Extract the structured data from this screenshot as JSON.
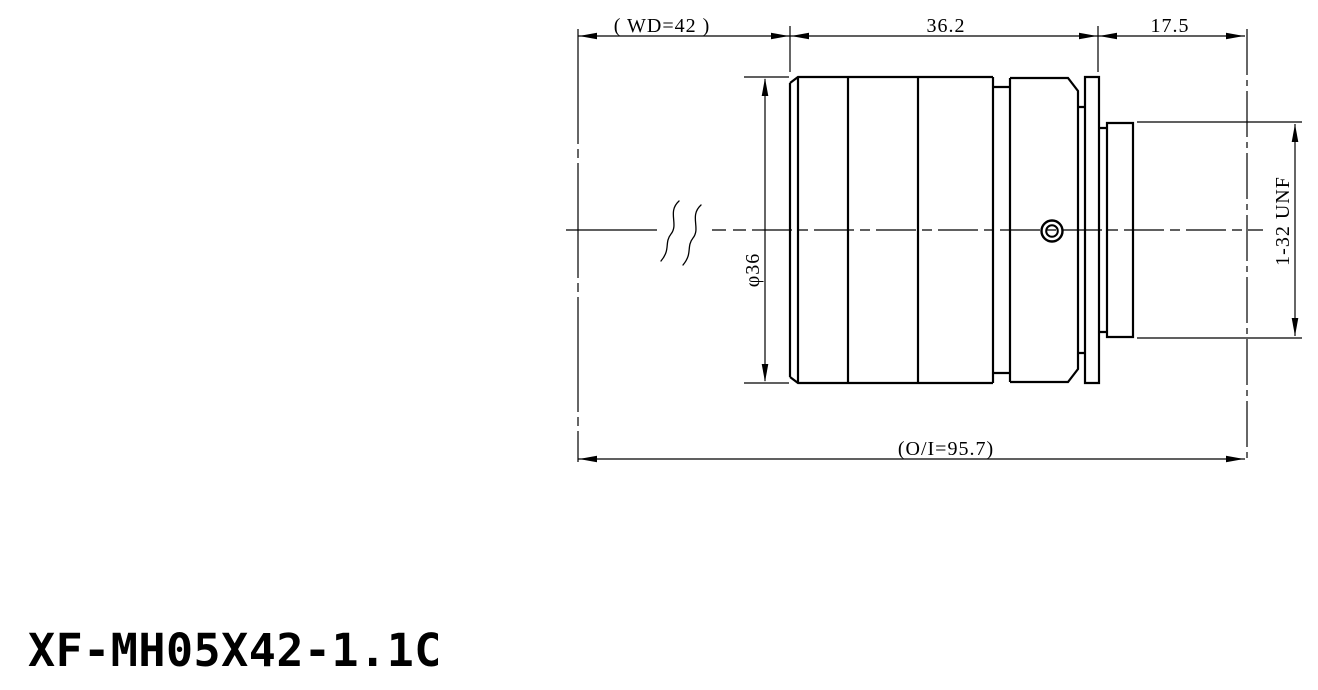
{
  "drawing": {
    "part_number": "XF-MH05X42-1.1C",
    "dim_working_distance": "( WD=42 )",
    "dim_body_length": "36.2",
    "dim_flange_focal": "17.5",
    "dim_overall": "(O/I=95.7)",
    "dim_diameter": "φ36",
    "dim_thread": "1-32 UNF"
  },
  "colors": {
    "ink": "#000000",
    "background": "#ffffff"
  }
}
